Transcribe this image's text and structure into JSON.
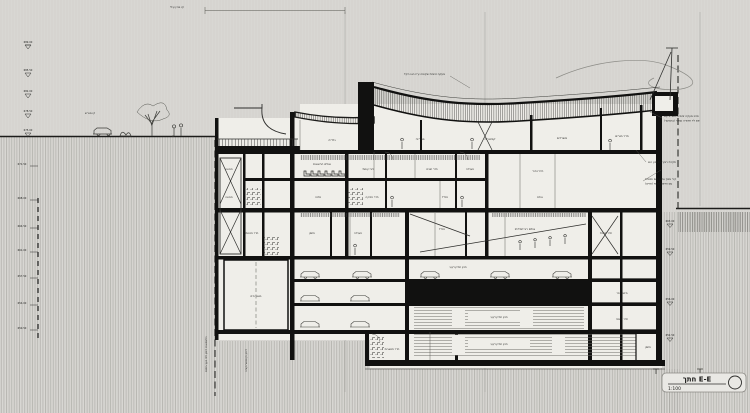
{
  "drawing": {
    "title": "חתך E-E",
    "scale": "1:100"
  },
  "top_notes": {
    "building_line": "קו בניין עילי",
    "lot_line_left": "קו מגרש",
    "roof_note": "מעקה זכוכית שקופה ע\"ג הגג הקל"
  },
  "side_notes": {
    "right_1a": "פרט מעקה זכוכית משולב עם",
    "right_1b": "פס לד תאורה נסתר (בהמשך)",
    "right_2": "תקרת רביץ בשיפוע הגג",
    "right_3a": "קיר מסך אלומיניום וזכוכית",
    "right_3b": "עם הדפס קרמי (פריט)",
    "pile_note_1": "כלונסאות דיפון לפי יועץ ביסוס",
    "pile_note_2": "דיפון וקונסטרוקציה"
  },
  "rooms": [
    {
      "text": "גלריה"
    },
    {
      "text": "ספרייה"
    },
    {
      "text": "קפיטריה"
    },
    {
      "text": "משרדים"
    },
    {
      "text": "חדר מורים"
    },
    {
      "text": "מבואה"
    },
    {
      "text": "אולם הרצאות"
    },
    {
      "text": "לובי קומתי"
    },
    {
      "text": "חדר חוגים"
    },
    {
      "text": "מעבדה"
    },
    {
      "text": "חלל כפול"
    },
    {
      "text": "מבואה"
    },
    {
      "text": "סדנה"
    },
    {
      "text": "חדר מוזיקה"
    },
    {
      "text": "ממ\"ד"
    },
    {
      "text": "אולם"
    },
    {
      "text": "חדר מכונות"
    },
    {
      "text": "מחסן"
    },
    {
      "text": "מעבדה"
    },
    {
      "text": "ממ\"ד"
    },
    {
      "text": "אולם רב־תכליתי"
    },
    {
      "text": "חדר חשמל"
    },
    {
      "text": "חניון תת־קרקעי"
    },
    {
      "text": "מאגר מים"
    },
    {
      "text": "חניון תת־קרקעי"
    },
    {
      "text": "חניון תת־קרקעי"
    },
    {
      "text": "חדר משאבות"
    },
    {
      "text": "מיזוג אוויר"
    },
    {
      "text": "חדר אשפה"
    },
    {
      "text": "מחסן"
    }
  ],
  "levels": {
    "left": [
      {
        "v": "689.00"
      },
      {
        "v": "685.50"
      },
      {
        "v": "682.00"
      },
      {
        "v": "678.50"
      },
      {
        "v": "675.00"
      }
    ],
    "shaft": [
      {
        "v": "671.50"
      },
      {
        "v": "668.00"
      },
      {
        "v": "664.50"
      },
      {
        "v": "661.00"
      },
      {
        "v": "657.50"
      },
      {
        "v": "654.00"
      },
      {
        "v": "650.50"
      }
    ],
    "right": [
      {
        "v": "663.00"
      },
      {
        "v": "659.50"
      },
      {
        "v": "656.00"
      },
      {
        "v": "652.50"
      }
    ]
  },
  "colors": {
    "background": "#d8d7d3",
    "interior": "#efeee9",
    "ink": "#1c1c1a",
    "poche": "#0f0f0e",
    "hatch": "#a5a49f"
  }
}
